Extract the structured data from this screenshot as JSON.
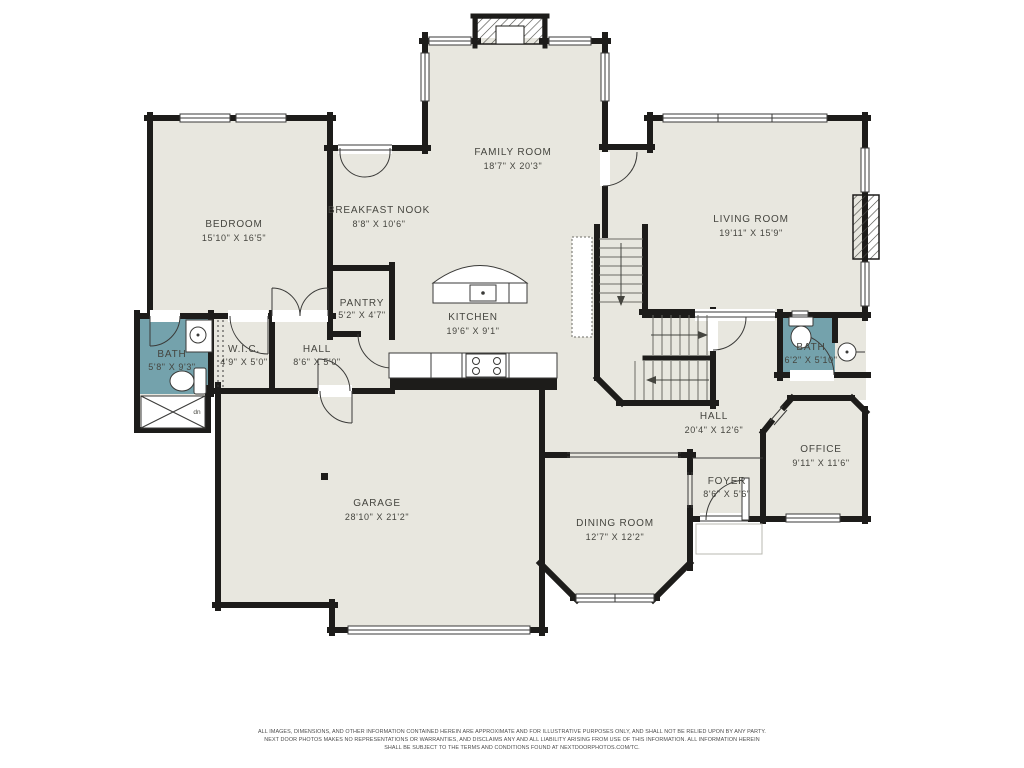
{
  "rooms": [
    {
      "id": "family-room",
      "name": "FAMILY ROOM",
      "dims": "18'7\" X 20'3\""
    },
    {
      "id": "bedroom",
      "name": "BEDROOM",
      "dims": "15'10\" X 16'5\""
    },
    {
      "id": "breakfast-nook",
      "name": "BREAKFAST NOOK",
      "dims": "8'8\" X 10'6\""
    },
    {
      "id": "living-room",
      "name": "LIVING ROOM",
      "dims": "19'11\" X 15'9\""
    },
    {
      "id": "pantry",
      "name": "PANTRY",
      "dims": "5'2\" X 4'7\""
    },
    {
      "id": "kitchen",
      "name": "KITCHEN",
      "dims": "19'6\" X 9'1\""
    },
    {
      "id": "bath-left",
      "name": "BATH",
      "dims": "5'8\" X 9'3\""
    },
    {
      "id": "wic",
      "name": "W.I.C.",
      "dims": "4'9\" X 5'0\""
    },
    {
      "id": "hall-left",
      "name": "HALL",
      "dims": "8'6\" X 5'0\""
    },
    {
      "id": "garage",
      "name": "GARAGE",
      "dims": "28'10\" X 21'2\""
    },
    {
      "id": "dining-room",
      "name": "DINING ROOM",
      "dims": "12'7\" X 12'2\""
    },
    {
      "id": "hall-right",
      "name": "HALL",
      "dims": "20'4\" X 12'6\""
    },
    {
      "id": "office",
      "name": "OFFICE",
      "dims": "9'11\" X 11'6\""
    },
    {
      "id": "foyer",
      "name": "FOYER",
      "dims": "8'6\" X 5'6\""
    },
    {
      "id": "bath-right",
      "name": "BATH",
      "dims": "6'2\" X 5'10\""
    }
  ],
  "annotations": {
    "stair_note": "dn"
  },
  "disclaimer": {
    "line1": "ALL IMAGES, DIMENSIONS, AND OTHER INFORMATION CONTAINED HEREIN ARE APPROXIMATE AND FOR ILLUSTRATIVE PURPOSES ONLY, AND SHALL NOT BE RELIED UPON BY ANY PARTY.",
    "line2": "NEXT DOOR PHOTOS MAKES NO REPRESENTATIONS OR WARRANTIES, AND DISCLAIMS ANY AND ALL LIABILITY ARISING FROM USE OF THIS INFORMATION. ALL INFORMATION HEREIN",
    "line3": "SHALL BE SUBJECT TO THE TERMS AND CONDITIONS FOUND AT NEXTDOORPHOTOS.COM/TC."
  },
  "colors": {
    "floor": "#e8e7df",
    "bath": "#74a2ac",
    "wall": "#1d1c1a"
  }
}
